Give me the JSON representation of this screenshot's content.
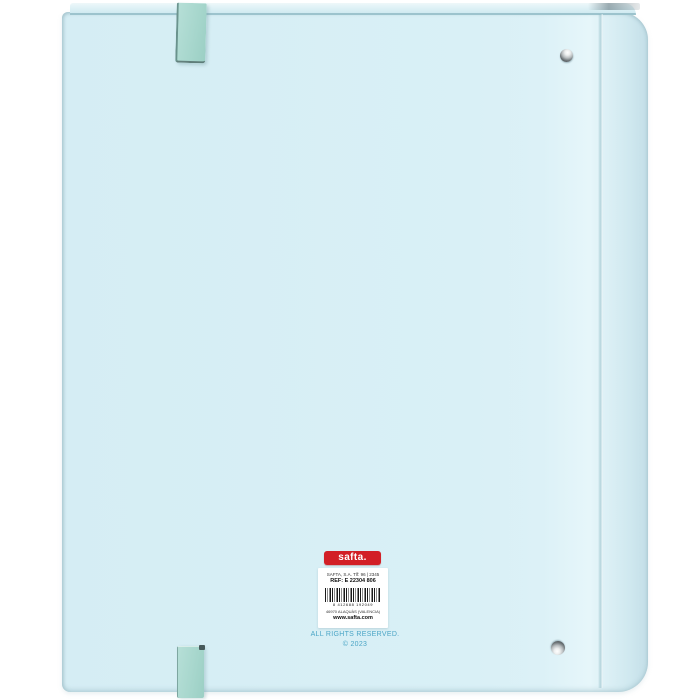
{
  "product": {
    "type": "ring-binder-back-view",
    "brand_logo_text": "safta.",
    "label": {
      "line1": "SAFTA, S.A. Tlf: 96 | 2345",
      "ref_line": "REF: E 22304 806",
      "barcode_number": "8 412688 192049",
      "address_line": "46970 ALAQUÀS (VALENCIA)",
      "website": "www.safta.com"
    },
    "copyright": {
      "line1": "ALL RIGHTS RESERVED.",
      "line2": "© 2023"
    }
  },
  "colors": {
    "background": "#ffffff",
    "binder_blue": "#d8eff5",
    "binder_edge": "#9cc3cd",
    "strap_mint": "#a9d8cf",
    "logo_red": "#d21f26",
    "label_white": "#ffffff",
    "copyright_blue": "#4ba5c6",
    "rivet_metal": "#9aa0a2"
  },
  "icons": {
    "rivet": "metal-rivet-circle",
    "barcode": "ean-barcode-bars",
    "strap": "elastic-band-tab"
  }
}
